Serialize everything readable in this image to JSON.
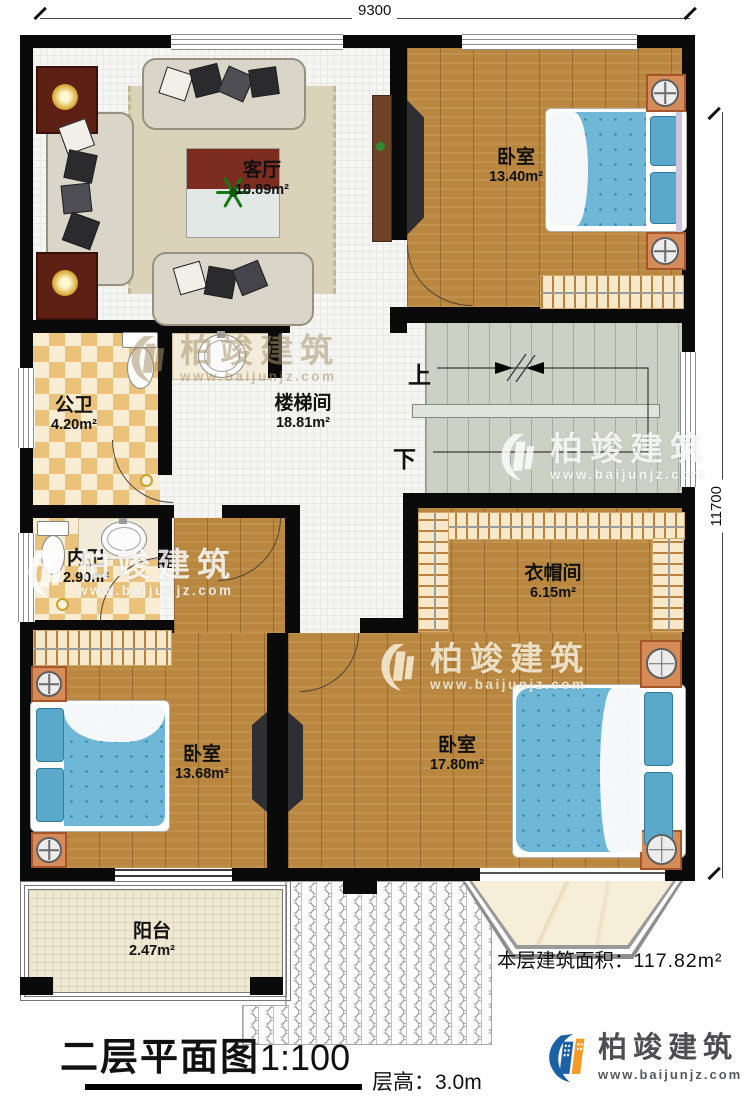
{
  "dimensions": {
    "width_label": "9300",
    "height_label": "11700"
  },
  "rooms": {
    "living": {
      "name": "客厅",
      "area": "18.89m²"
    },
    "bedroom_top_right": {
      "name": "卧室",
      "area": "13.40m²"
    },
    "public_bath": {
      "name": "公卫",
      "area": "4.20m²"
    },
    "stair_hall": {
      "name": "楼梯间",
      "area": "18.81m²"
    },
    "inner_bath": {
      "name": "内卫",
      "area": "2.90m²"
    },
    "cloakroom": {
      "name": "衣帽间",
      "area": "6.15m²"
    },
    "bedroom_bottom_left": {
      "name": "卧室",
      "area": "13.68m²"
    },
    "bedroom_bottom_right": {
      "name": "卧室",
      "area": "17.80m²"
    },
    "balcony": {
      "name": "阳台",
      "area": "2.47m²"
    }
  },
  "stairs": {
    "up_label": "上",
    "down_label": "下"
  },
  "annotations": {
    "floor_area_label": "本层建筑面积：",
    "floor_area_value": "117.82m²",
    "plan_title": "二层平面图",
    "plan_scale": "1:100",
    "floor_height": "层高：3.0m"
  },
  "brand": {
    "name": "柏竣建筑",
    "url": "www.baijunjz.com"
  },
  "watermark": {
    "name": "柏竣建筑",
    "url": "www.baijunjz.com"
  },
  "colors": {
    "accent_blue": "#1b61a6",
    "accent_orange": "#f59a23",
    "wall": "#0a0a0a"
  }
}
